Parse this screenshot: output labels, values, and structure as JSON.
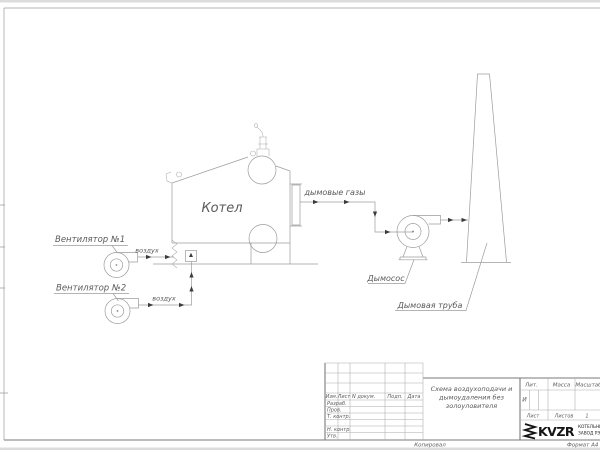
{
  "drawing": {
    "boiler_label": "Котел",
    "fan1_label": "Вентилятор №1",
    "fan2_label": "Вентилятор №2",
    "air_label_1": "воздух",
    "air_label_2": "воздух",
    "flue_gas_label": "дымовые газы",
    "exhauster_label": "Дымосос",
    "chimney_label": "Дымовая труба"
  },
  "title_block": {
    "col_izm": "Изм.",
    "col_list": "Лист",
    "col_docnum": "N докум.",
    "col_sign": "Подп.",
    "col_date": "Дата",
    "row_razrab": "Разраб.",
    "row_prov": "Пров.",
    "row_tcontr": "Т. контр.",
    "row_ncontr": "Н. контр.",
    "row_utv": "Утв.",
    "title_lines": [
      "Схема воздухоподачи и",
      "дымоудаления без",
      "золоуловителя"
    ],
    "lit_header": "Лит.",
    "lit_value": "И",
    "mass_header": "Масса",
    "scale_header": "Масштаб",
    "sheet_label": "Лист",
    "sheets_label": "Листов",
    "sheets_value": "1",
    "logo_text": "KVZR",
    "company_line1": "КОТЕЛЬНЫЙ",
    "company_line2": "ЗАВОД РЭ",
    "copied_label": "Копировал",
    "format_label": "Формат А4"
  }
}
